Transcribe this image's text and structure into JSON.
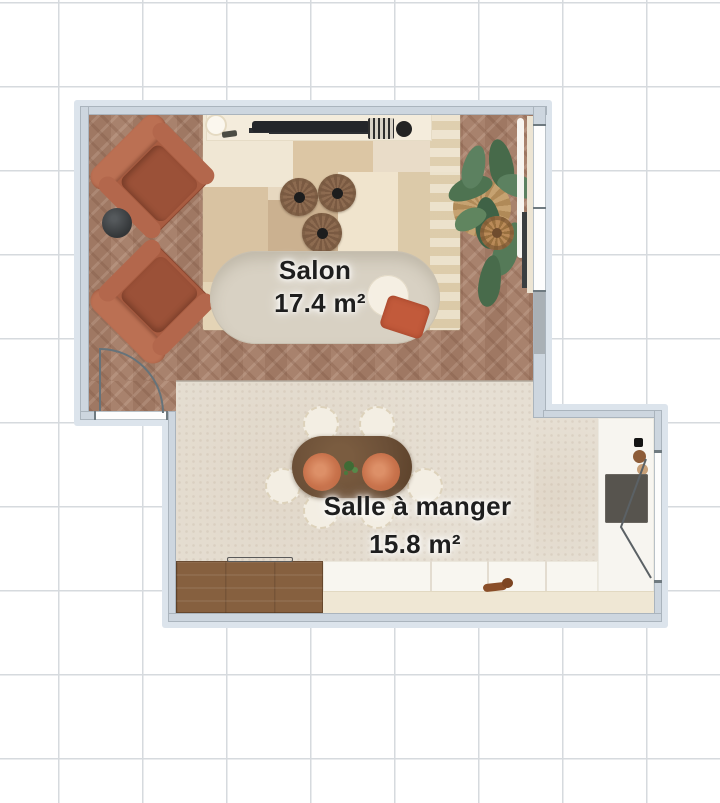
{
  "app": {
    "view": "2d-floor-plan"
  },
  "rooms": [
    {
      "name": "Salon",
      "area_label": "17.4 m²"
    },
    {
      "name": "Salle à manger",
      "area_label": "15.8 m²"
    }
  ],
  "furniture_icons": [
    "armchair-icon",
    "side-table-icon",
    "rug-icon",
    "tv-console-icon",
    "tv-soundbar-icon",
    "jute-pouf-icon",
    "sofa-icon",
    "throw-pillow-icon",
    "plant-icon",
    "rattan-pouf-icon",
    "curtain-icon",
    "radiator-icon",
    "dining-table-icon",
    "plate-icon",
    "dining-chair-icon",
    "sideboard-icon",
    "kitchen-counter-icon",
    "dog-icon",
    "appliance-icon",
    "door-swing-icon",
    "window-icon"
  ],
  "palette": {
    "background": "#ffffff",
    "grid_line": "#d6dade",
    "wall": "#cdd6df",
    "wall_halo": "#dce4ec",
    "salon_floor": "#a57d67",
    "dining_floor": "#e6dfd3",
    "kitchen_floor": "#f7f5f0",
    "rug_base": "#e7d8c0",
    "armchair_terracotta": "#a85c41",
    "sofa_cream": "#d8d1c3",
    "table_wood": "#6b4f37",
    "pillow_terracotta": "#c25a3b",
    "plant_green": "#557a58",
    "label_text": "#1e1e1e"
  }
}
